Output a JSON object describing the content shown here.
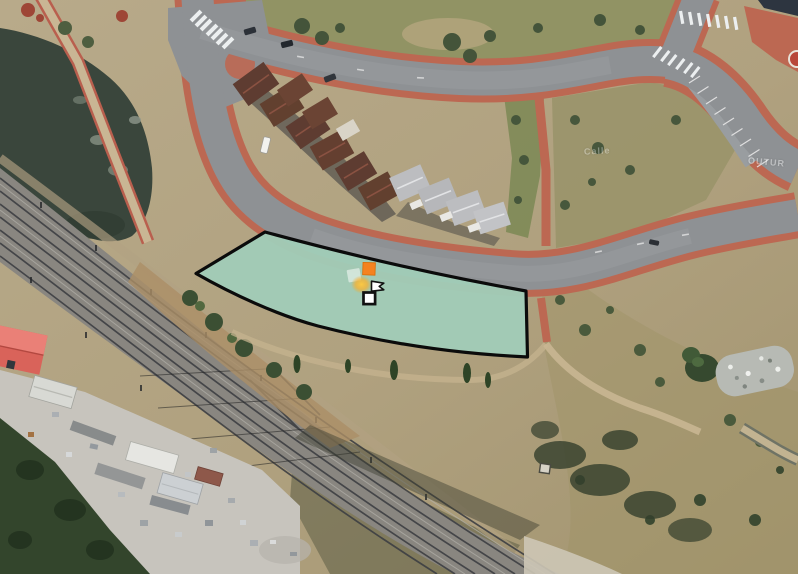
{
  "view": {
    "type": "aerial-satellite-view",
    "description": "Aerial photo of a curved residential street with townhouses, a railway corridor, an industrial yard and a highlighted land parcel"
  },
  "street_labels": {
    "label_1": "Calle",
    "label_2": "OUTUR"
  },
  "parcel": {
    "fill_color": "#A1CBB7",
    "stroke_color": "#0B0B0B"
  },
  "markers": {
    "selection_square_color": "#F5821F",
    "ghost_square_color": "#FFFFFF",
    "glow_color": "#FFC83D",
    "flag_fill": "#FFFFFF",
    "flag_stroke": "#111111",
    "vertex_fill": "#FFFFFF",
    "vertex_stroke": "#111111"
  }
}
